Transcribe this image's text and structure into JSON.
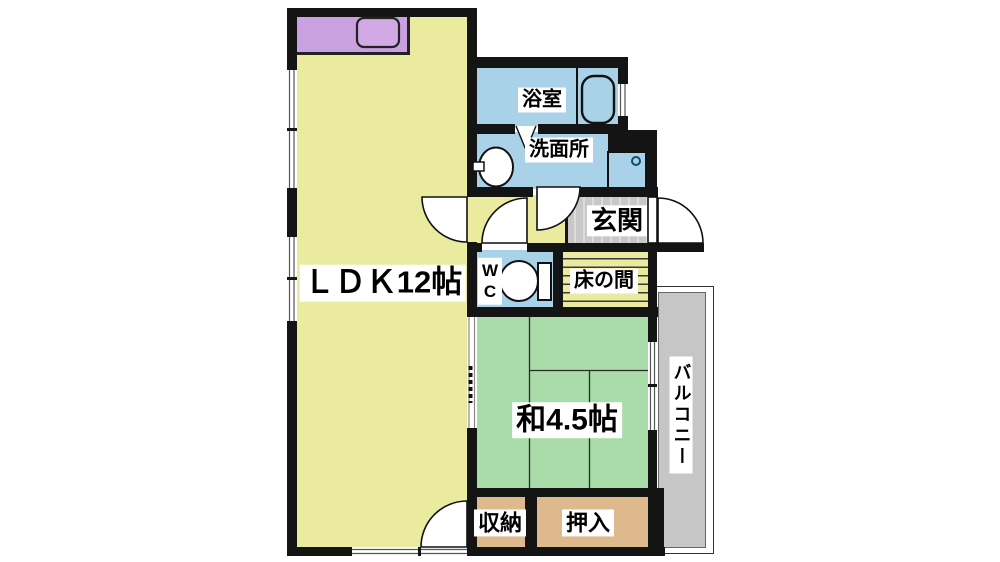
{
  "plan": {
    "rooms": {
      "ldk": "ＬＤＫ12帖",
      "bathroom": "浴室",
      "washroom": "洗面所",
      "entrance": "玄関",
      "wc_line1": "W",
      "wc_line2": "C",
      "tokonoma": "床の間",
      "japanese_room": "和4.5帖",
      "storage": "収納",
      "closet": "押入",
      "balcony": "バルコニー"
    },
    "colors": {
      "background": "#ffffff",
      "wall": "#141414",
      "ldk_floor": "#eaeb9f",
      "kitchen_counter": "#c9a0e0",
      "water_rooms": "#a9d2e9",
      "tatami": "#a9dca9",
      "entrance_floor": "#c8c8c8",
      "closet_floor": "#deb98e",
      "balcony_floor": "#c6c6c6"
    }
  }
}
